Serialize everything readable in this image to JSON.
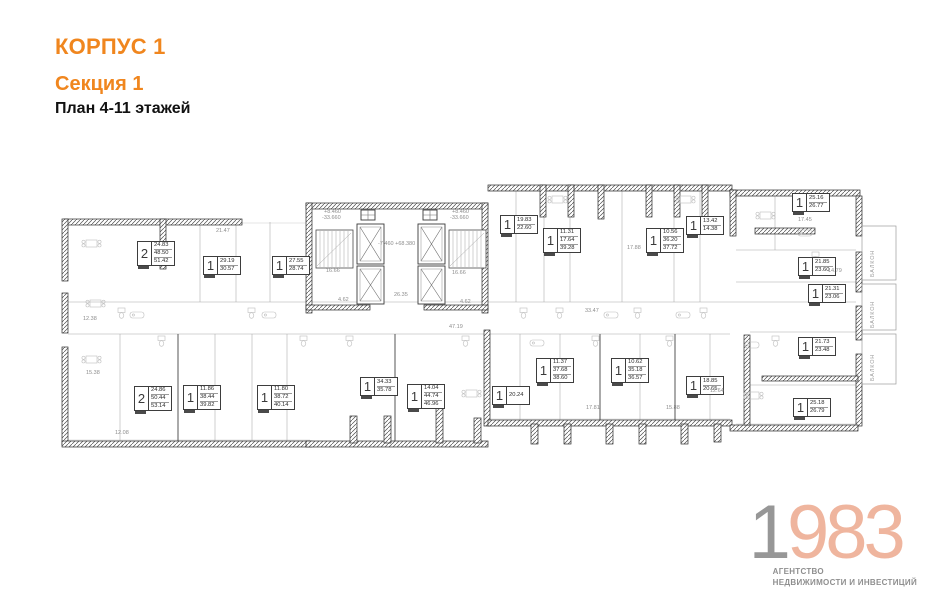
{
  "header": {
    "building": "КОРПУС 1",
    "section": "Секция 1",
    "plan_title": "План 4-11 этажей"
  },
  "colors": {
    "accent": "#F0861E",
    "plan_wall": "#2b2b2b",
    "logo_year_gray": "#979797",
    "logo_year_peach": "#EFB59E",
    "logo_text_gray": "#8F8F8F"
  },
  "apartments": [
    {
      "rooms": "2",
      "areas": [
        "24.83",
        "48.50",
        "51.42"
      ],
      "x": 137,
      "y": 241
    },
    {
      "rooms": "1",
      "areas": [
        "29.19",
        "30.57"
      ],
      "x": 203,
      "y": 256
    },
    {
      "rooms": "1",
      "areas": [
        "27.55",
        "28.74"
      ],
      "x": 272,
      "y": 256
    },
    {
      "rooms": "1",
      "areas": [
        "19.83",
        "22.60"
      ],
      "x": 500,
      "y": 215
    },
    {
      "rooms": "1",
      "areas": [
        "11.31",
        "17.64",
        "39.28"
      ],
      "x": 543,
      "y": 228
    },
    {
      "rooms": "1",
      "areas": [
        "10.56",
        "36.20",
        "37.72"
      ],
      "x": 646,
      "y": 228
    },
    {
      "rooms": "1",
      "areas": [
        "13.42",
        "14.38"
      ],
      "x": 686,
      "y": 216
    },
    {
      "rooms": "1",
      "areas": [
        "25.16",
        "26.77"
      ],
      "x": 792,
      "y": 193
    },
    {
      "rooms": "1",
      "areas": [
        "21.85",
        "23.60"
      ],
      "x": 798,
      "y": 257
    },
    {
      "rooms": "1",
      "areas": [
        "21.31",
        "23.06"
      ],
      "x": 808,
      "y": 284
    },
    {
      "rooms": "1",
      "areas": [
        "21.73",
        "23.48"
      ],
      "x": 798,
      "y": 337
    },
    {
      "rooms": "1",
      "areas": [
        "25.18",
        "26.79"
      ],
      "x": 793,
      "y": 398
    },
    {
      "rooms": "2",
      "areas": [
        "24.86",
        "50.44",
        "53.14"
      ],
      "x": 134,
      "y": 386
    },
    {
      "rooms": "1",
      "areas": [
        "11.86",
        "38.44",
        "39.82"
      ],
      "x": 183,
      "y": 385
    },
    {
      "rooms": "1",
      "areas": [
        "11.80",
        "38.72",
        "40.14"
      ],
      "x": 257,
      "y": 385
    },
    {
      "rooms": "1",
      "areas": [
        "34.33",
        "35.78"
      ],
      "x": 360,
      "y": 377
    },
    {
      "rooms": "1",
      "areas": [
        "14.04",
        "44.74",
        "46.96"
      ],
      "x": 407,
      "y": 384
    },
    {
      "rooms": "1",
      "areas": [
        "20.24"
      ],
      "x": 492,
      "y": 386
    },
    {
      "rooms": "1",
      "areas": [
        "11.37",
        "37.68",
        "38.60"
      ],
      "x": 536,
      "y": 358
    },
    {
      "rooms": "1",
      "areas": [
        "10.62",
        "35.18",
        "36.57"
      ],
      "x": 611,
      "y": 358
    },
    {
      "rooms": "1",
      "areas": [
        "18.85",
        "20.65"
      ],
      "x": 686,
      "y": 376
    }
  ],
  "dimensions": [
    {
      "text": "21.47",
      "x": 216,
      "y": 228
    },
    {
      "text": "+8.460",
      "x": 324,
      "y": 209
    },
    {
      "text": "-33.660",
      "x": 322,
      "y": 215
    },
    {
      "text": "+8.460",
      "x": 452,
      "y": 209
    },
    {
      "text": "-33.660",
      "x": 450,
      "y": 215
    },
    {
      "text": "-7.460  +68.380",
      "x": 378,
      "y": 241
    },
    {
      "text": "16.66",
      "x": 326,
      "y": 268
    },
    {
      "text": "16.66",
      "x": 452,
      "y": 270
    },
    {
      "text": "26.35",
      "x": 394,
      "y": 292
    },
    {
      "text": "4.62",
      "x": 338,
      "y": 297
    },
    {
      "text": "4.62",
      "x": 460,
      "y": 299
    },
    {
      "text": "47.19",
      "x": 449,
      "y": 324
    },
    {
      "text": "33.47",
      "x": 585,
      "y": 308
    },
    {
      "text": "17.88",
      "x": 627,
      "y": 245
    },
    {
      "text": "17.45",
      "x": 798,
      "y": 217
    },
    {
      "text": "14.79",
      "x": 828,
      "y": 268
    },
    {
      "text": "12.38",
      "x": 83,
      "y": 316
    },
    {
      "text": "15.38",
      "x": 86,
      "y": 370
    },
    {
      "text": "12.08",
      "x": 115,
      "y": 430
    },
    {
      "text": "17.81",
      "x": 586,
      "y": 405
    },
    {
      "text": "15.88",
      "x": 666,
      "y": 405
    },
    {
      "text": "12.64",
      "x": 710,
      "y": 388
    }
  ],
  "balconies": [
    {
      "label": "БАЛКОН",
      "x": 870,
      "y": 231,
      "h": 46
    },
    {
      "label": "БАЛКОН",
      "x": 870,
      "y": 288,
      "h": 40
    },
    {
      "label": "БАЛКОН",
      "x": 870,
      "y": 337,
      "h": 44
    }
  ],
  "logo": {
    "year_gray": "1",
    "year_colored": "983",
    "line1": "АГЕНТСТВО",
    "line2": "НЕДВИЖИМОСТИ И ИНВЕСТИЦИЙ"
  }
}
